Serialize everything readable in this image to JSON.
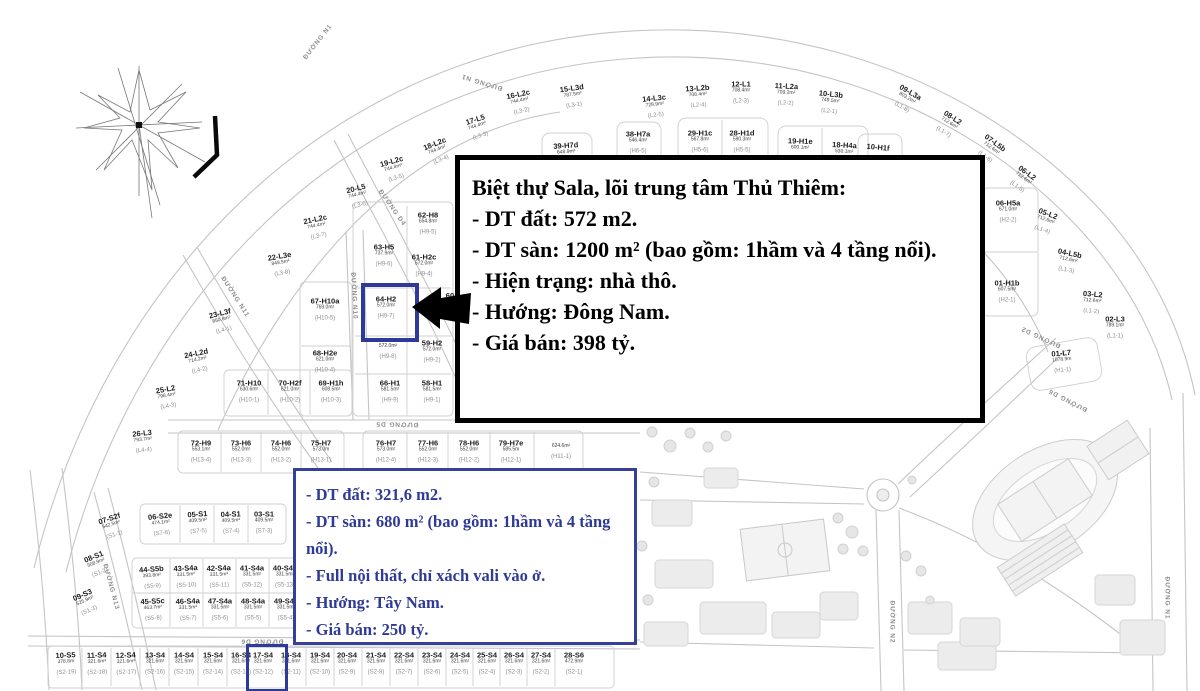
{
  "black_box": {
    "lines": [
      "Biệt thự Sala, lõi trung tâm Thủ Thiêm:",
      " - DT đất: 572 m2.",
      " - DT sàn: 1200 m² (bao gồm: 1hầm và 4 tầng nổi).",
      " - Hiện trạng: nhà thô.",
      " - Hướng: Đông Nam.",
      " - Giá bán: 398 tỷ."
    ]
  },
  "blue_box": {
    "lines": [
      " - DT đất: 321,6 m2.",
      " - DT sàn: 680 m² (bao gồm: 1hầm và 4 tầng nổi).",
      " - Full nội thất, chỉ xách vali vào ở.",
      " - Hướng: Tây Nam.",
      " - Giá bán: 250 tỷ."
    ]
  },
  "colors": {
    "highlight_border": "#2d3a9a",
    "blue_text": "#2e3a96",
    "map_line": "#c4c4c4"
  },
  "highlighted_plots": [
    "64-H2",
    "17-S4"
  ],
  "plots": [
    {
      "n": "15-L3d",
      "a": "787.5m²",
      "c": "(L3-1)",
      "x": 573,
      "y": 97,
      "r": -8
    },
    {
      "n": "16-L2c",
      "a": "744.4m²",
      "c": "(L3-2)",
      "x": 520,
      "y": 103,
      "r": -12
    },
    {
      "n": "17-L5",
      "a": "744.4m²",
      "c": "(L3-3)",
      "x": 478,
      "y": 128,
      "r": -18
    },
    {
      "n": "18-L2c",
      "a": "744.4m²",
      "c": "(L3-4)",
      "x": 438,
      "y": 152,
      "r": -22
    },
    {
      "n": "19-L2c",
      "a": "744.4m²",
      "c": "(L3-5)",
      "x": 394,
      "y": 170,
      "r": -16
    },
    {
      "n": "20-L5",
      "a": "744.4m²",
      "c": "(L3-6)",
      "x": 358,
      "y": 197,
      "r": -14
    },
    {
      "n": "21-L2c",
      "a": "744.4m²",
      "c": "(L3-7)",
      "x": 317,
      "y": 228,
      "r": -12
    },
    {
      "n": "22-L3e",
      "a": "849.5m²",
      "c": "(L3-8)",
      "x": 281,
      "y": 265,
      "r": -10
    },
    {
      "n": "23-L3f",
      "a": "850.8m²",
      "c": "(L4-1)",
      "x": 222,
      "y": 322,
      "r": -14
    },
    {
      "n": "24-L2d",
      "a": "714.2m²",
      "c": "(L4-2)",
      "x": 198,
      "y": 362,
      "r": -12
    },
    {
      "n": "25-L2",
      "a": "798.4m²",
      "c": "(L4-3)",
      "x": 167,
      "y": 398,
      "r": -10
    },
    {
      "n": "26-L3",
      "a": "793.7m²",
      "c": "(L4-4)",
      "x": 143,
      "y": 442,
      "r": -6
    },
    {
      "n": "14-L3c",
      "a": "728.9m²",
      "c": "(L2-5)",
      "x": 655,
      "y": 107,
      "r": -6
    },
    {
      "n": "13-L2b",
      "a": "708.4m²",
      "c": "(L2-4)",
      "x": 698,
      "y": 97,
      "r": -4
    },
    {
      "n": "12-L1",
      "a": "708.4m²",
      "c": "(L2-3)",
      "x": 741,
      "y": 93,
      "r": 0
    },
    {
      "n": "11-L2a",
      "a": "709.2m²",
      "c": "(L2-2)",
      "x": 786,
      "y": 95,
      "r": 3
    },
    {
      "n": "10-L3b",
      "a": "749.5m²",
      "c": "(L2-1)",
      "x": 830,
      "y": 103,
      "r": 6
    },
    {
      "n": "09-L3a",
      "a": "803.2m²",
      "c": "(L1-8)",
      "x": 906,
      "y": 100,
      "r": 30
    },
    {
      "n": "08-L2",
      "a": "712.6m²",
      "c": "(L1-7)",
      "x": 948,
      "y": 125,
      "r": 33
    },
    {
      "n": "07-L5b",
      "a": "712.6m²",
      "c": "(L1-6)",
      "x": 990,
      "y": 150,
      "r": 36
    },
    {
      "n": "06-L2",
      "a": "712.6m²",
      "c": "(L1-5)",
      "x": 1022,
      "y": 180,
      "r": 36
    },
    {
      "n": "05-L2",
      "a": "712.6m²",
      "c": "(L1-4)",
      "x": 1045,
      "y": 222,
      "r": 20
    },
    {
      "n": "04-L5b",
      "a": "712.6m²",
      "c": "(L1-3)",
      "x": 1068,
      "y": 262,
      "r": 12
    },
    {
      "n": "03-L2",
      "a": "712.6m²",
      "c": "(L1-2)",
      "x": 1092,
      "y": 303,
      "r": 5
    },
    {
      "n": "02-L3",
      "a": "789.1m²",
      "c": "(L1-1)",
      "x": 1115,
      "y": 328,
      "r": 0
    },
    {
      "n": "01-L7",
      "a": "1078.9m",
      "c": "(H1-1)",
      "x": 1062,
      "y": 362,
      "r": -5
    },
    {
      "n": "39-H7d",
      "a": "648.9m²",
      "c": "",
      "x": 566,
      "y": 149,
      "r": -4
    },
    {
      "n": "38-H7a",
      "a": "546.4m²",
      "c": "(H6-5)",
      "x": 638,
      "y": 143,
      "r": 0
    },
    {
      "n": "29-H1c",
      "a": "567.8m²",
      "c": "(H5-6)",
      "x": 700,
      "y": 142,
      "r": 0
    },
    {
      "n": "28-H1d",
      "a": "590.3m²",
      "c": "(H5-5)",
      "x": 742,
      "y": 142,
      "r": 0
    },
    {
      "n": "19-H1e",
      "a": "600.1m²",
      "c": "(H4-6)",
      "x": 800,
      "y": 150,
      "r": 2
    },
    {
      "n": "18-H4a",
      "a": "530.1m²",
      "c": "(H4-5)",
      "x": 844,
      "y": 154,
      "r": 3
    },
    {
      "n": "10-H1f",
      "a": "",
      "c": "",
      "x": 878,
      "y": 148,
      "r": 5
    },
    {
      "n": "06-H5a",
      "a": "671.0m²",
      "c": "(H2-2)",
      "x": 1008,
      "y": 212,
      "r": 0
    },
    {
      "n": "01-H1b",
      "a": "607.5m²",
      "c": "(H2-1)",
      "x": 1007,
      "y": 292,
      "r": 0
    },
    {
      "n": "62-H8",
      "a": "654.8m²",
      "c": "(H9-5)",
      "x": 428,
      "y": 224,
      "r": 0
    },
    {
      "n": "63-H5",
      "a": "737.9m²",
      "c": "(H9-6)",
      "x": 384,
      "y": 256,
      "r": 0
    },
    {
      "n": "61-H2c",
      "a": "572.0m²",
      "c": "(H9-4)",
      "x": 424,
      "y": 266,
      "r": 0
    },
    {
      "n": "64-H2",
      "a": "572.0m²",
      "c": "(H9-7)",
      "x": 386,
      "y": 308,
      "r": 0,
      "hl": true
    },
    {
      "n": "60-H2",
      "a": "",
      "c": "",
      "x": 456,
      "y": 296,
      "r": 0
    },
    {
      "n": "",
      "a": "572.0m²",
      "c": "(H9-8)",
      "x": 388,
      "y": 352,
      "r": 0
    },
    {
      "n": "59-H2",
      "a": "572.0m²",
      "c": "(H9-2)",
      "x": 432,
      "y": 352,
      "r": 0
    },
    {
      "n": "66-H1",
      "a": "581.5m²",
      "c": "(H9-9)",
      "x": 390,
      "y": 392,
      "r": 0
    },
    {
      "n": "58-H1",
      "a": "581.5m²",
      "c": "(H9-1)",
      "x": 432,
      "y": 392,
      "r": 0
    },
    {
      "n": "67-H10a",
      "a": "769.0m²",
      "c": "(H10-5)",
      "x": 325,
      "y": 310,
      "r": 0
    },
    {
      "n": "68-H2e",
      "a": "621.0m²",
      "c": "(H10-4)",
      "x": 325,
      "y": 362,
      "r": 0
    },
    {
      "n": "71-H10",
      "a": "630.6m²",
      "c": "(H10-1)",
      "x": 249,
      "y": 392,
      "r": 0
    },
    {
      "n": "70-H2f",
      "a": "621.0m²",
      "c": "(H10-2)",
      "x": 290,
      "y": 392,
      "r": 0
    },
    {
      "n": "69-H1h",
      "a": "608.5m²",
      "c": "(H10-3)",
      "x": 331,
      "y": 392,
      "r": 0
    },
    {
      "n": "72-H9",
      "a": "553.1m²",
      "c": "(H13-4)",
      "x": 201,
      "y": 452,
      "r": 0
    },
    {
      "n": "73-H6",
      "a": "552.0m²",
      "c": "(H13-3)",
      "x": 241,
      "y": 452,
      "r": 0
    },
    {
      "n": "74-H6",
      "a": "552.0m²",
      "c": "(H13-2)",
      "x": 281,
      "y": 452,
      "r": 0
    },
    {
      "n": "75-H7",
      "a": "573.0m",
      "c": "(H13-1)",
      "x": 321,
      "y": 452,
      "r": 0
    },
    {
      "n": "76-H7",
      "a": "573.0m²",
      "c": "(H12-4)",
      "x": 386,
      "y": 452,
      "r": 0
    },
    {
      "n": "77-H6",
      "a": "552.0m²",
      "c": "(H12-3)",
      "x": 428,
      "y": 452,
      "r": 0
    },
    {
      "n": "78-H6",
      "a": "552.0m²",
      "c": "(H12-2)",
      "x": 469,
      "y": 452,
      "r": 0
    },
    {
      "n": "79-H7e",
      "a": "585.5m",
      "c": "(H12-1)",
      "x": 511,
      "y": 452,
      "r": 0
    },
    {
      "n": "",
      "a": "624.6m²",
      "c": "(H11-1)",
      "x": 561,
      "y": 452,
      "r": 0
    },
    {
      "n": "07-S2f",
      "a": "542.5m²",
      "c": "(S1-1)",
      "x": 112,
      "y": 527,
      "r": -18
    },
    {
      "n": "08-S1",
      "a": "508.9m²",
      "c": "(S1-2)",
      "x": 97,
      "y": 565,
      "r": -22
    },
    {
      "n": "09-S3",
      "a": "525.9m²",
      "c": "(S1-3)",
      "x": 86,
      "y": 603,
      "r": -24
    },
    {
      "n": "06-S2e",
      "a": "474.1m²",
      "c": "(S7-6)",
      "x": 161,
      "y": 525,
      "r": -6
    },
    {
      "n": "05-S1",
      "a": "409.5m²",
      "c": "(S7-5)",
      "x": 198,
      "y": 523,
      "r": -4
    },
    {
      "n": "04-S1",
      "a": "409.5m²",
      "c": "(S7-4)",
      "x": 231,
      "y": 523,
      "r": -2
    },
    {
      "n": "03-S1",
      "a": "409.5m²",
      "c": "(S7-3)",
      "x": 264,
      "y": 523,
      "r": 0
    },
    {
      "n": "44-S5b",
      "a": "393.8m²",
      "c": "(S5-9)",
      "x": 152,
      "y": 578,
      "r": -4
    },
    {
      "n": "43-S4a",
      "a": "331.5m²",
      "c": "(S5-10)",
      "x": 186,
      "y": 577,
      "r": -3
    },
    {
      "n": "42-S4a",
      "a": "331.5m²",
      "c": "(S5-11)",
      "x": 219,
      "y": 577,
      "r": -2
    },
    {
      "n": "41-S4a",
      "a": "331.5m²",
      "c": "(S5-12)",
      "x": 252,
      "y": 577,
      "r": 0
    },
    {
      "n": "40-S4a",
      "a": "331.5m²",
      "c": "(S5-13)",
      "x": 285,
      "y": 577,
      "r": 0
    },
    {
      "n": "45-S5c",
      "a": "463.7m²",
      "c": "(S5-8)",
      "x": 153,
      "y": 610,
      "r": -3
    },
    {
      "n": "46-S4a",
      "a": "331.5m²",
      "c": "(S5-7)",
      "x": 188,
      "y": 610,
      "r": -2
    },
    {
      "n": "47-S4a",
      "a": "331.5m²",
      "c": "(S5-6)",
      "x": 220,
      "y": 610,
      "r": 0
    },
    {
      "n": "48-S4a",
      "a": "331.5m²",
      "c": "(S5-5)",
      "x": 253,
      "y": 610,
      "r": 0
    },
    {
      "n": "49-S4a",
      "a": "331.5m²",
      "c": "(S5-4)",
      "x": 286,
      "y": 610,
      "r": 0
    },
    {
      "n": "10-S5",
      "a": "378.8m",
      "c": "(S2-19)",
      "x": 66,
      "y": 664,
      "r": -3
    },
    {
      "n": "11-S4",
      "a": "321.6m²",
      "c": "(S2-18)",
      "x": 97,
      "y": 664,
      "r": -2
    },
    {
      "n": "12-S4",
      "a": "321.6m²",
      "c": "(S2-17)",
      "x": 126,
      "y": 664,
      "r": -2
    },
    {
      "n": "13-S4",
      "a": "321.6m²",
      "c": "(S2-16)",
      "x": 155,
      "y": 664,
      "r": 0
    },
    {
      "n": "14-S4",
      "a": "321.6m²",
      "c": "(S2-15)",
      "x": 184,
      "y": 664,
      "r": 0
    },
    {
      "n": "15-S4",
      "a": "321.6m²",
      "c": "(S2-14)",
      "x": 213,
      "y": 664,
      "r": 0
    },
    {
      "n": "16-S4",
      "a": "321.6m²",
      "c": "(S2-13)",
      "x": 241,
      "y": 664,
      "r": 0
    },
    {
      "n": "17-S4",
      "a": "321.6m²",
      "c": "(S2-12)",
      "x": 263,
      "y": 664,
      "r": 0,
      "hl": true
    },
    {
      "n": "18-S4",
      "a": "321.6m²",
      "c": "(S2-11)",
      "x": 291,
      "y": 664,
      "r": 0
    },
    {
      "n": "19-S4",
      "a": "321.6m²",
      "c": "(S2-10)",
      "x": 320,
      "y": 664,
      "r": 0
    },
    {
      "n": "20-S4",
      "a": "321.6m²",
      "c": "(S2-9)",
      "x": 347,
      "y": 664,
      "r": 0
    },
    {
      "n": "21-S4",
      "a": "321.6m²",
      "c": "(S2-8)",
      "x": 376,
      "y": 664,
      "r": 0
    },
    {
      "n": "22-S4",
      "a": "321.6m²",
      "c": "(S2-7)",
      "x": 404,
      "y": 664,
      "r": 0
    },
    {
      "n": "23-S4",
      "a": "321.6m²",
      "c": "(S2-6)",
      "x": 432,
      "y": 664,
      "r": 0
    },
    {
      "n": "24-S4",
      "a": "321.6m²",
      "c": "(S2-5)",
      "x": 460,
      "y": 664,
      "r": 0
    },
    {
      "n": "25-S4",
      "a": "321.6m²",
      "c": "(S2-4)",
      "x": 487,
      "y": 664,
      "r": 0
    },
    {
      "n": "26-S4",
      "a": "321.6m²",
      "c": "(S2-3)",
      "x": 514,
      "y": 664,
      "r": 0
    },
    {
      "n": "27-S4",
      "a": "321.6m²",
      "c": "(S2-2)",
      "x": 541,
      "y": 664,
      "r": 0
    },
    {
      "n": "28-S6",
      "a": "472.9m²",
      "c": "(S2-1)",
      "x": 574,
      "y": 664,
      "r": 0
    }
  ],
  "streets": [
    {
      "t": "ĐƯỜNG N1",
      "x": 318,
      "y": 42,
      "r": -52
    },
    {
      "t": "ĐƯỜNG N1",
      "x": 482,
      "y": 82,
      "r": 197
    },
    {
      "t": "ĐƯỜNG D1",
      "x": 678,
      "y": 201,
      "r": 183
    },
    {
      "t": "ĐƯỜNG D4",
      "x": 392,
      "y": 208,
      "r": 55
    },
    {
      "t": "ĐƯỜNG N10",
      "x": 354,
      "y": 296,
      "r": 87
    },
    {
      "t": "ĐƯỜNG N11",
      "x": 235,
      "y": 297,
      "r": 57
    },
    {
      "t": "ĐƯỜNG N13",
      "x": 111,
      "y": 587,
      "r": 75
    },
    {
      "t": "ĐƯỜNG D5",
      "x": 397,
      "y": 424,
      "r": 181
    },
    {
      "t": "ĐƯỜNG D2",
      "x": 1041,
      "y": 337,
      "r": 205
    },
    {
      "t": "ĐƯỜNG D6",
      "x": 1068,
      "y": 400,
      "r": 207
    },
    {
      "t": "ĐƯỜNG D6",
      "x": 262,
      "y": 641,
      "r": 180
    },
    {
      "t": "ĐƯỜNG N2",
      "x": 892,
      "y": 622,
      "r": 90
    },
    {
      "t": "ĐƯỜNG N1",
      "x": 1167,
      "y": 598,
      "r": 90
    }
  ]
}
